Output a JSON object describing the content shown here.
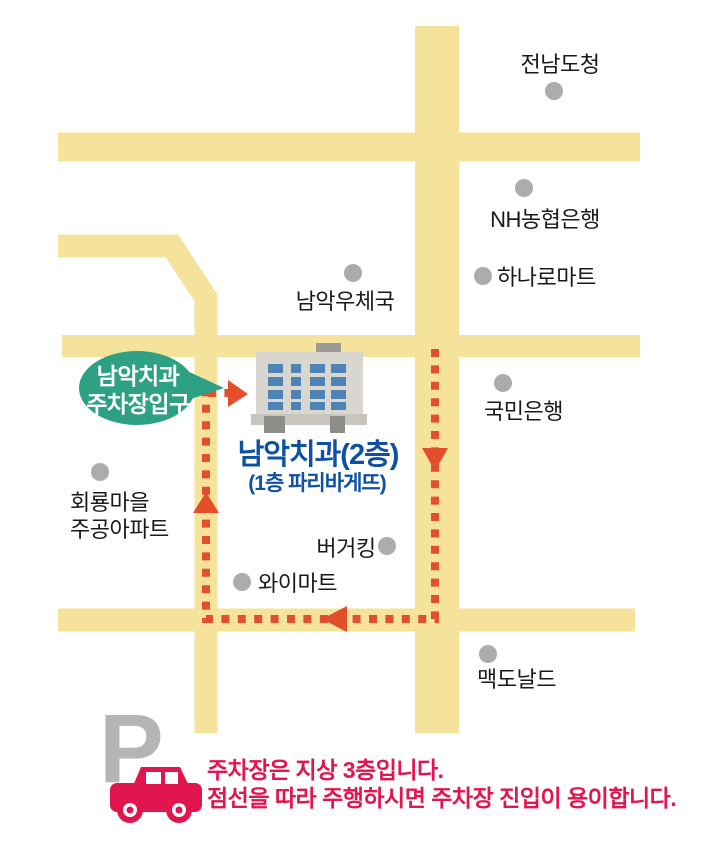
{
  "map": {
    "places": {
      "provincial_office": {
        "label": "전남도청"
      },
      "nh_bank": {
        "label": "NH농협은행"
      },
      "hanaro_mart": {
        "label": "하나로마트"
      },
      "post_office": {
        "label": "남악우체국"
      },
      "kookmin_bank": {
        "label": "국민은행"
      },
      "hoeryong_apartment": {
        "label_line1": "회룡마을",
        "label_line2": "주공아파트"
      },
      "burger_king": {
        "label": "버거킹"
      },
      "y_mart": {
        "label": "와이마트"
      },
      "mcdonalds": {
        "label": "맥도날드"
      }
    },
    "clinic": {
      "title": "남악치과(2층)",
      "subtitle": "(1층 파리바게뜨)"
    },
    "bubble": {
      "line1": "남악치과",
      "line2": "주차장입구"
    }
  },
  "parking_note": {
    "symbol": "P",
    "line1": "주차장은 지상 3층입니다.",
    "line2": "점선을 따라 주행하시면 주차장 진입이 용이합니다."
  },
  "colors": {
    "road": "#F5E39B",
    "route": "#E34E2B",
    "bubble": "#2EA184",
    "bubble_text": "#FFFFFF",
    "clinic_text": "#0E51A4",
    "note_text": "#E2154E",
    "label_text": "#1A1A1A",
    "dot": "#ACACAC",
    "building_body": "#D9D6CF",
    "building_roof": "#9B9B95",
    "building_base": "#C8C5BE",
    "building_door": "#8E8E88",
    "building_window": "#4D83B5",
    "car": "#E2164E",
    "parking_symbol": "#B5B5B5"
  }
}
